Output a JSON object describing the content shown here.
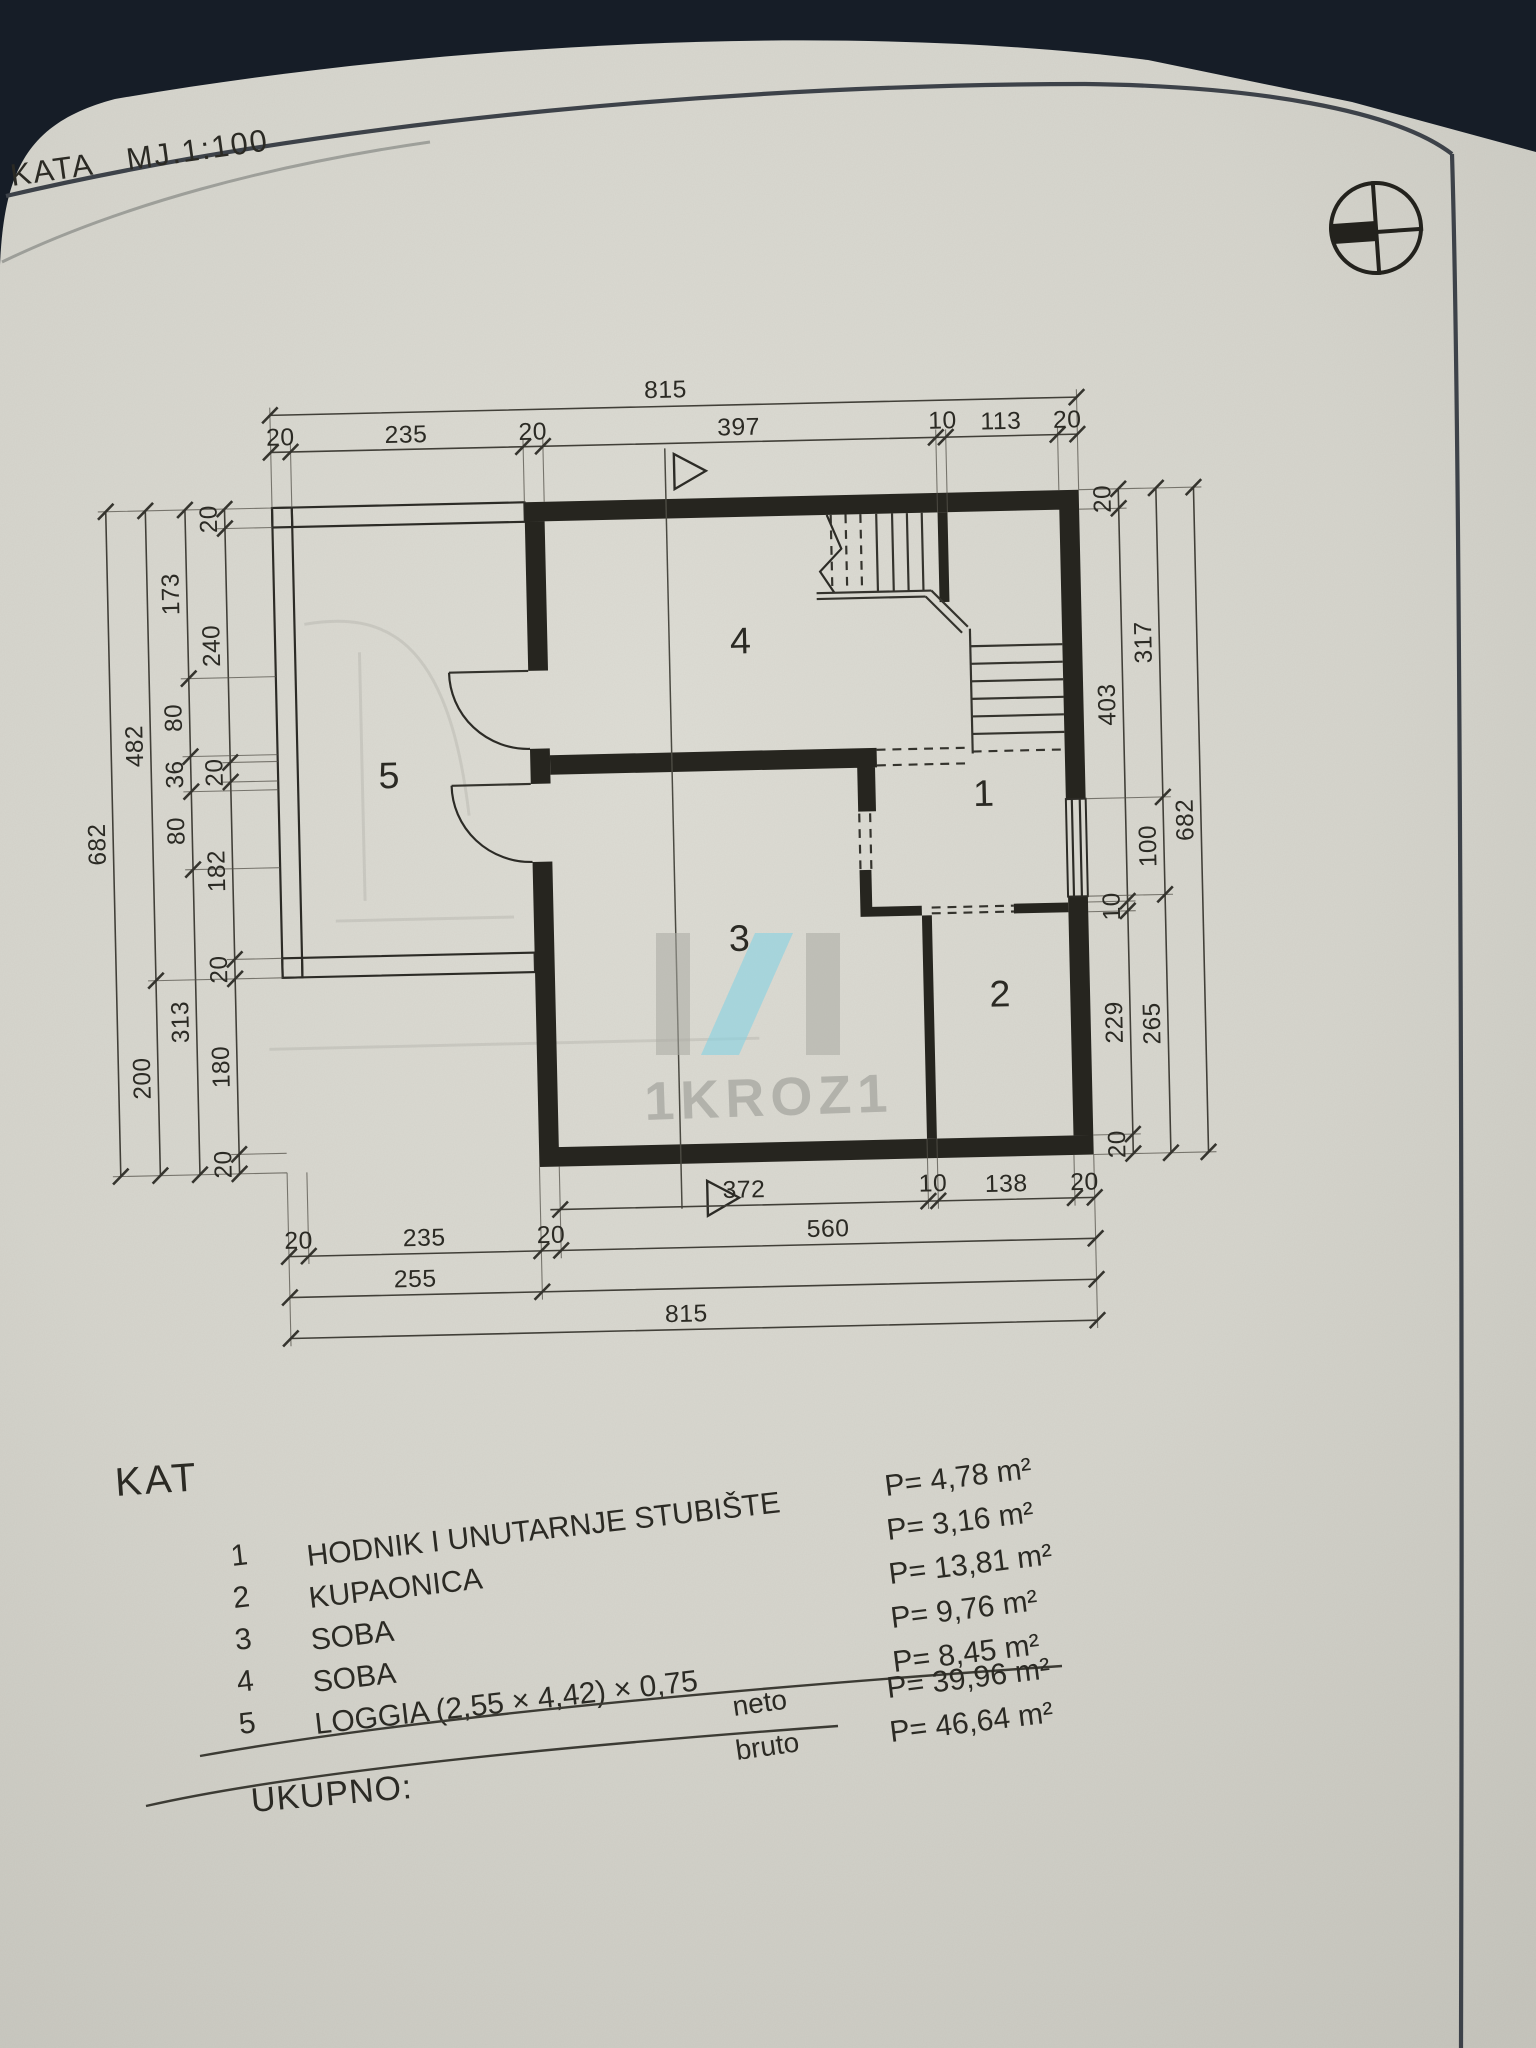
{
  "photo": {
    "background": "#161d27",
    "paper": "#d7d6ce"
  },
  "title": {
    "room": "KATA",
    "scale": "MJ.1:100"
  },
  "plan": {
    "room_labels": [
      "1",
      "2",
      "3",
      "4",
      "5"
    ],
    "dims": {
      "total_w": "815",
      "total_h": "682",
      "top": [
        "20",
        "235",
        "20",
        "397",
        "10",
        "113",
        "20"
      ],
      "left_inner": [
        "20",
        "240",
        "20",
        "182",
        "20",
        "180",
        "20"
      ],
      "left_mid": [
        "173",
        "80",
        "36",
        "80",
        "313"
      ],
      "left_outer": [
        "482",
        "200"
      ],
      "right_inner": [
        "20",
        "403",
        "10",
        "229",
        "20"
      ],
      "right_mid": [
        "317",
        "100",
        "265"
      ],
      "bottom_inner": [
        "372",
        "10",
        "138",
        "20"
      ],
      "bottom_mid": [
        "20",
        "235",
        "20",
        "560"
      ],
      "bottom_outer": "255",
      "bottom_total": "815"
    }
  },
  "watermark": {
    "text": "1KROZ1",
    "accent": "#85d2e2",
    "gray": "#a6a6a0"
  },
  "legend": {
    "heading": "KAT",
    "rows": [
      {
        "num": "1",
        "name": "HODNIK I UNUTARNJE STUBIŠTE",
        "area": "P= 4,78 m²"
      },
      {
        "num": "2",
        "name": "KUPAONICA",
        "area": "P= 3,16 m²"
      },
      {
        "num": "3",
        "name": "SOBA",
        "area": "P= 13,81 m²"
      },
      {
        "num": "4",
        "name": "SOBA",
        "area": "P= 9,76 m²"
      },
      {
        "num": "5",
        "name": "LOGGIA (2,55 × 4,42) × 0,75",
        "area": "P= 8,45 m²"
      }
    ],
    "neto_label": "neto",
    "neto_area": "P= 39,96 m²",
    "bruto_label": "bruto",
    "bruto_area": "P= 46,64 m²",
    "total_label": "UKUPNO:"
  }
}
